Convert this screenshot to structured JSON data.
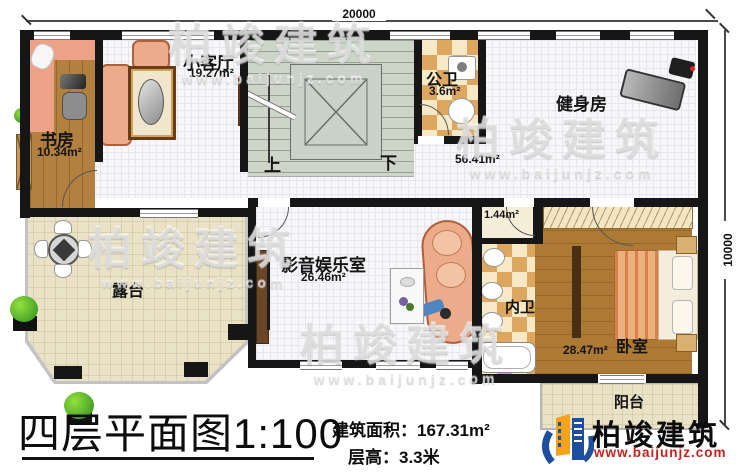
{
  "dimensions": {
    "width": "20000",
    "height": "10000"
  },
  "rooms": {
    "study": {
      "label": "书房",
      "area": "10.34m²"
    },
    "living": {
      "label": "小客厅",
      "area": "19.27m²"
    },
    "public_bath": {
      "label": "公卫",
      "area": "3.6m²"
    },
    "gym": {
      "label": "健身房",
      "area": "56.41m²"
    },
    "media": {
      "label": "影音娱乐室",
      "area": "26.46m²"
    },
    "terrace": {
      "label": "露台"
    },
    "inner_bath": {
      "label": "内卫",
      "area": "1.44m²"
    },
    "bedroom": {
      "label": "卧室",
      "area": "28.47m²"
    },
    "balcony": {
      "label": "阳台"
    }
  },
  "stairs": {
    "up": "上",
    "down": "下"
  },
  "footer": {
    "plan_title": "四层平面图",
    "scale": "1:100",
    "area_label": "建筑面积：",
    "area_value": "167.31m²",
    "floor_height_label": "层高：",
    "floor_height_value": "3.3米"
  },
  "brand": {
    "name": "柏竣建筑",
    "website": "www.baijunjz.com"
  },
  "watermark": {
    "text": "柏竣建筑",
    "subtext": "www.baijunjz.com"
  },
  "colors": {
    "wall": "#161616",
    "wood": "#b2803f",
    "stairs": "#ccd5c8",
    "terrace": "#e9e2c6",
    "checker_dark": "#dda75f",
    "checker_light": "#f7e9c6",
    "salmon": "#ecab8b",
    "brand_blue": "#1d4f9e",
    "brand_orange": "#f5a21d",
    "brand_red": "#c8201d"
  }
}
